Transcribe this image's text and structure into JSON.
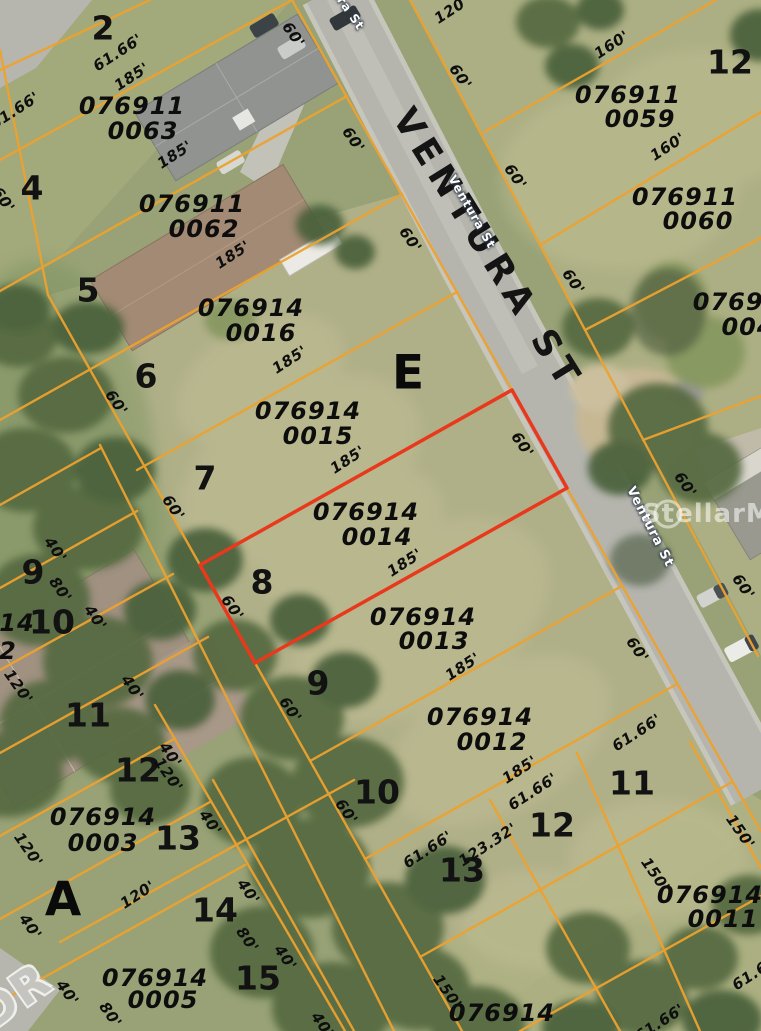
{
  "map": {
    "type": "aerial-parcel-map",
    "highlighted_parcel": {
      "id_line1": "076914",
      "id_line2": "0014",
      "outline_color": "#e8391c",
      "frontage": "60'",
      "depth": "185'"
    },
    "street_name": "VENTURA ST",
    "watermark": "StellarMLS",
    "colors": {
      "parcel_line": "#eda22f",
      "highlight": "#e8391c",
      "road": "#b5b5ae",
      "grass": "#98a276"
    }
  },
  "labels": [
    {
      "t": "076911",
      "x": 132,
      "y": 106,
      "c": "pid",
      "n": "parcel-id-076911-0063"
    },
    {
      "t": "0063",
      "x": 143,
      "y": 131,
      "c": "pid",
      "n": "parcel-id-076911-0063"
    },
    {
      "t": "076911",
      "x": 192,
      "y": 204,
      "c": "pid",
      "n": "parcel-id-076911-0062"
    },
    {
      "t": "0062",
      "x": 204,
      "y": 229,
      "c": "pid",
      "n": "parcel-id-076911-0062"
    },
    {
      "t": "076914",
      "x": 251,
      "y": 308,
      "c": "pid",
      "n": "parcel-id-076914-0016"
    },
    {
      "t": "0016",
      "x": 261,
      "y": 333,
      "c": "pid",
      "n": "parcel-id-076914-0016"
    },
    {
      "t": "076914",
      "x": 308,
      "y": 411,
      "c": "pid",
      "n": "parcel-id-076914-0015"
    },
    {
      "t": "0015",
      "x": 318,
      "y": 436,
      "c": "pid",
      "n": "parcel-id-076914-0015"
    },
    {
      "t": "076914",
      "x": 366,
      "y": 512,
      "c": "pid",
      "n": "parcel-id-076914-0014"
    },
    {
      "t": "0014",
      "x": 377,
      "y": 537,
      "c": "pid",
      "n": "parcel-id-076914-0014"
    },
    {
      "t": "076914",
      "x": 423,
      "y": 617,
      "c": "pid",
      "n": "parcel-id-076914-0013"
    },
    {
      "t": "0013",
      "x": 434,
      "y": 641,
      "c": "pid",
      "n": "parcel-id-076914-0013"
    },
    {
      "t": "076914",
      "x": 480,
      "y": 717,
      "c": "pid",
      "n": "parcel-id-076914-0012"
    },
    {
      "t": "0012",
      "x": 492,
      "y": 742,
      "c": "pid",
      "n": "parcel-id-076914-0012"
    },
    {
      "t": "076911",
      "x": 628,
      "y": 95,
      "c": "pid",
      "n": "parcel-id-076911-0059"
    },
    {
      "t": "0059",
      "x": 640,
      "y": 119,
      "c": "pid",
      "n": "parcel-id-076911-0059"
    },
    {
      "t": "076911",
      "x": 685,
      "y": 197,
      "c": "pid",
      "n": "parcel-id-076911-0060"
    },
    {
      "t": "0060",
      "x": 698,
      "y": 221,
      "c": "pid",
      "n": "parcel-id-076911-0060"
    },
    {
      "t": "07691",
      "x": 737,
      "y": 302,
      "c": "pid",
      "n": "parcel-id-partial-right"
    },
    {
      "t": "004",
      "x": 748,
      "y": 327,
      "c": "pid",
      "n": "parcel-id-partial-right"
    },
    {
      "t": "076914",
      "x": 103,
      "y": 817,
      "c": "pid",
      "n": "parcel-id-076914-0003"
    },
    {
      "t": "0003",
      "x": 103,
      "y": 843,
      "c": "pid",
      "n": "parcel-id-076914-0003"
    },
    {
      "t": "076914",
      "x": 155,
      "y": 978,
      "c": "pid",
      "n": "parcel-id-076914-0005"
    },
    {
      "t": "0005",
      "x": 163,
      "y": 1000,
      "c": "pid",
      "n": "parcel-id-076914-0005"
    },
    {
      "t": "076914",
      "x": 710,
      "y": 895,
      "c": "pid",
      "n": "parcel-id-076914-0011"
    },
    {
      "t": "0011",
      "x": 723,
      "y": 919,
      "c": "pid",
      "n": "parcel-id-076914-0011"
    },
    {
      "t": "076914",
      "x": 502,
      "y": 1013,
      "c": "pid",
      "n": "parcel-id-partial-bottom"
    },
    {
      "t": "14",
      "x": 17,
      "y": 623,
      "c": "pid",
      "n": "parcel-id-partial-left"
    },
    {
      "t": "2",
      "x": 8,
      "y": 651,
      "c": "pid",
      "n": "parcel-id-partial-left"
    },
    {
      "t": "2",
      "x": 103,
      "y": 28,
      "c": "lot",
      "n": "lot-number-2"
    },
    {
      "t": "4",
      "x": 32,
      "y": 188,
      "c": "lot",
      "n": "lot-number-4"
    },
    {
      "t": "5",
      "x": 88,
      "y": 290,
      "c": "lot",
      "n": "lot-number-5"
    },
    {
      "t": "6",
      "x": 146,
      "y": 376,
      "c": "lot",
      "n": "lot-number-6"
    },
    {
      "t": "7",
      "x": 205,
      "y": 478,
      "c": "lot",
      "n": "lot-number-7"
    },
    {
      "t": "8",
      "x": 262,
      "y": 582,
      "c": "lot",
      "n": "lot-number-8"
    },
    {
      "t": "9",
      "x": 318,
      "y": 683,
      "c": "lot",
      "n": "lot-number-9"
    },
    {
      "t": "10",
      "x": 377,
      "y": 792,
      "c": "lot",
      "n": "lot-number-10"
    },
    {
      "t": "9",
      "x": 33,
      "y": 572,
      "c": "lot",
      "n": "lot-number-9-west"
    },
    {
      "t": "10",
      "x": 52,
      "y": 622,
      "c": "lot",
      "n": "lot-number-10-west"
    },
    {
      "t": "11",
      "x": 88,
      "y": 715,
      "c": "lot",
      "n": "lot-number-11-west"
    },
    {
      "t": "12",
      "x": 138,
      "y": 770,
      "c": "lot",
      "n": "lot-number-12-west"
    },
    {
      "t": "13",
      "x": 178,
      "y": 838,
      "c": "lot",
      "n": "lot-number-13-west"
    },
    {
      "t": "14",
      "x": 215,
      "y": 910,
      "c": "lot",
      "n": "lot-number-14-west"
    },
    {
      "t": "15",
      "x": 258,
      "y": 978,
      "c": "lot",
      "n": "lot-number-15-west"
    },
    {
      "t": "11",
      "x": 632,
      "y": 783,
      "c": "lot",
      "n": "lot-number-11-east"
    },
    {
      "t": "12",
      "x": 552,
      "y": 825,
      "c": "lot",
      "n": "lot-number-12-east"
    },
    {
      "t": "13",
      "x": 462,
      "y": 870,
      "c": "lot",
      "n": "lot-number-13-east"
    },
    {
      "t": "12",
      "x": 730,
      "y": 62,
      "c": "lot",
      "n": "lot-number-12-northeast"
    },
    {
      "t": "E",
      "x": 408,
      "y": 373,
      "c": "blk",
      "n": "block-letter-e"
    },
    {
      "t": "A",
      "x": 63,
      "y": 900,
      "c": "blk",
      "n": "block-letter-a"
    },
    {
      "t": "61.66'",
      "x": 118,
      "y": 53,
      "r": -33,
      "c": "dim",
      "n": "dimension-label"
    },
    {
      "t": "185'",
      "x": 132,
      "y": 77,
      "r": -33,
      "c": "dim",
      "n": "dimension-label"
    },
    {
      "t": "61.66'",
      "x": 15,
      "y": 111,
      "r": -33,
      "c": "dim",
      "n": "dimension-label"
    },
    {
      "t": "185'",
      "x": 175,
      "y": 155,
      "r": -33,
      "c": "dim",
      "n": "dimension-label"
    },
    {
      "t": "185'",
      "x": 233,
      "y": 255,
      "r": -33,
      "c": "dim",
      "n": "dimension-label"
    },
    {
      "t": "185'",
      "x": 290,
      "y": 360,
      "r": -33,
      "c": "dim",
      "n": "dimension-label"
    },
    {
      "t": "185'",
      "x": 348,
      "y": 460,
      "r": -33,
      "c": "dim",
      "n": "dimension-label"
    },
    {
      "t": "185'",
      "x": 405,
      "y": 563,
      "r": -33,
      "c": "dim",
      "n": "dimension-label"
    },
    {
      "t": "185'",
      "x": 463,
      "y": 667,
      "r": -33,
      "c": "dim",
      "n": "dimension-label"
    },
    {
      "t": "185'",
      "x": 520,
      "y": 770,
      "r": -33,
      "c": "dim",
      "n": "dimension-label"
    },
    {
      "t": "61.66'",
      "x": 533,
      "y": 792,
      "r": -33,
      "c": "dim",
      "n": "dimension-label"
    },
    {
      "t": "123.32'",
      "x": 488,
      "y": 845,
      "r": -33,
      "c": "dim",
      "n": "dimension-label"
    },
    {
      "t": "61.66'",
      "x": 428,
      "y": 850,
      "r": -33,
      "c": "dim",
      "n": "dimension-label"
    },
    {
      "t": "61.66'",
      "x": 637,
      "y": 733,
      "r": -33,
      "c": "dim",
      "n": "dimension-label"
    },
    {
      "t": "120'",
      "x": 452,
      "y": 10,
      "r": -33,
      "c": "dim",
      "n": "dimension-label"
    },
    {
      "t": "160'",
      "x": 612,
      "y": 45,
      "r": -33,
      "c": "dim",
      "n": "dimension-label"
    },
    {
      "t": "160'",
      "x": 668,
      "y": 147,
      "r": -33,
      "c": "dim",
      "n": "dimension-label"
    },
    {
      "t": "120'",
      "x": 138,
      "y": 895,
      "r": -33,
      "c": "dim",
      "n": "dimension-label"
    },
    {
      "t": "61.66'",
      "x": 660,
      "y": 1023,
      "r": -33,
      "c": "dim",
      "n": "dimension-label"
    },
    {
      "t": "61.66'",
      "x": 757,
      "y": 972,
      "r": -33,
      "c": "dim",
      "n": "dimension-label"
    },
    {
      "t": "60'",
      "x": 293,
      "y": 35,
      "r": 55,
      "c": "dim",
      "n": "dimension-label"
    },
    {
      "t": "60'",
      "x": 353,
      "y": 140,
      "r": 55,
      "c": "dim",
      "n": "dimension-label"
    },
    {
      "t": "60'",
      "x": 460,
      "y": 77,
      "r": 55,
      "c": "dim",
      "n": "dimension-label"
    },
    {
      "t": "60'",
      "x": 515,
      "y": 177,
      "r": 55,
      "c": "dim",
      "n": "dimension-label"
    },
    {
      "t": "60'",
      "x": 410,
      "y": 240,
      "r": 55,
      "c": "dim",
      "n": "dimension-label"
    },
    {
      "t": "60'",
      "x": 573,
      "y": 282,
      "r": 55,
      "c": "dim",
      "n": "dimension-label"
    },
    {
      "t": "60'",
      "x": 685,
      "y": 485,
      "r": 55,
      "c": "dim",
      "n": "dimension-label"
    },
    {
      "t": "60'",
      "x": 743,
      "y": 587,
      "r": 55,
      "c": "dim",
      "n": "dimension-label"
    },
    {
      "t": "60'",
      "x": 637,
      "y": 650,
      "r": 55,
      "c": "dim",
      "n": "dimension-label"
    },
    {
      "t": "60'",
      "x": 346,
      "y": 812,
      "r": 55,
      "c": "dim",
      "n": "dimension-label"
    },
    {
      "t": "60'",
      "x": 116,
      "y": 403,
      "r": 55,
      "c": "dim",
      "n": "dimension-label"
    },
    {
      "t": "60'",
      "x": 173,
      "y": 508,
      "r": 55,
      "c": "dim",
      "n": "dimension-label"
    },
    {
      "t": "60'",
      "x": 232,
      "y": 608,
      "r": 55,
      "c": "dim",
      "n": "dimension-label"
    },
    {
      "t": "60'",
      "x": 290,
      "y": 710,
      "r": 55,
      "c": "dim",
      "n": "dimension-label"
    },
    {
      "t": "60'",
      "x": 522,
      "y": 445,
      "r": 55,
      "c": "dim",
      "n": "dimension-label"
    },
    {
      "t": "60'",
      "x": 3,
      "y": 200,
      "r": 55,
      "c": "dim",
      "n": "dimension-label"
    },
    {
      "t": "40'",
      "x": 55,
      "y": 550,
      "r": 55,
      "c": "dim",
      "n": "dimension-label"
    },
    {
      "t": "40'",
      "x": 95,
      "y": 618,
      "r": 55,
      "c": "dim",
      "n": "dimension-label"
    },
    {
      "t": "40'",
      "x": 132,
      "y": 688,
      "r": 55,
      "c": "dim",
      "n": "dimension-label"
    },
    {
      "t": "40'",
      "x": 170,
      "y": 755,
      "r": 55,
      "c": "dim",
      "n": "dimension-label"
    },
    {
      "t": "40'",
      "x": 210,
      "y": 823,
      "r": 55,
      "c": "dim",
      "n": "dimension-label"
    },
    {
      "t": "40'",
      "x": 248,
      "y": 892,
      "r": 55,
      "c": "dim",
      "n": "dimension-label"
    },
    {
      "t": "40'",
      "x": 285,
      "y": 958,
      "r": 55,
      "c": "dim",
      "n": "dimension-label"
    },
    {
      "t": "40'",
      "x": 30,
      "y": 927,
      "r": 55,
      "c": "dim",
      "n": "dimension-label"
    },
    {
      "t": "40'",
      "x": 67,
      "y": 993,
      "r": 55,
      "c": "dim",
      "n": "dimension-label"
    },
    {
      "t": "40'",
      "x": 322,
      "y": 1025,
      "r": 55,
      "c": "dim",
      "n": "dimension-label"
    },
    {
      "t": "80'",
      "x": 60,
      "y": 590,
      "r": 55,
      "c": "dim",
      "n": "dimension-label"
    },
    {
      "t": "80'",
      "x": 247,
      "y": 940,
      "r": 55,
      "c": "dim",
      "n": "dimension-label"
    },
    {
      "t": "80'",
      "x": 110,
      "y": 1015,
      "r": 55,
      "c": "dim",
      "n": "dimension-label"
    },
    {
      "t": "120'",
      "x": 18,
      "y": 687,
      "r": 55,
      "c": "dim",
      "n": "dimension-label"
    },
    {
      "t": "120'",
      "x": 28,
      "y": 850,
      "r": 55,
      "c": "dim",
      "n": "dimension-label"
    },
    {
      "t": "120'",
      "x": 168,
      "y": 775,
      "r": 55,
      "c": "dim",
      "n": "dimension-label"
    },
    {
      "t": "150'",
      "x": 740,
      "y": 832,
      "r": 55,
      "c": "dim",
      "n": "dimension-label"
    },
    {
      "t": "150'",
      "x": 655,
      "y": 875,
      "r": 55,
      "c": "dim",
      "n": "dimension-label"
    },
    {
      "t": "150'",
      "x": 447,
      "y": 992,
      "r": 55,
      "c": "dim",
      "n": "dimension-label"
    },
    {
      "t": "VENTURA ST",
      "x": 487,
      "y": 250,
      "r": 58,
      "c": "vs",
      "n": "street-name-ventura-st"
    },
    {
      "t": "Ventura St",
      "x": 338,
      "y": -5,
      "r": 55,
      "c": "ssm",
      "n": "street-name-small"
    },
    {
      "t": "Ventura St",
      "x": 472,
      "y": 212,
      "r": 60,
      "c": "ssm",
      "n": "street-name-small"
    },
    {
      "t": "Ventura St",
      "x": 650,
      "y": 527,
      "r": 63,
      "c": "ssm ssm2",
      "n": "street-name-small"
    },
    {
      "t": "StellarMLS",
      "x": 726,
      "y": 514,
      "c": "wm",
      "n": "watermark-stellar-mls"
    },
    {
      "t": "DR",
      "x": 14,
      "y": 996,
      "r": -35,
      "c": "dr",
      "n": "road-name-partial-dr"
    }
  ]
}
